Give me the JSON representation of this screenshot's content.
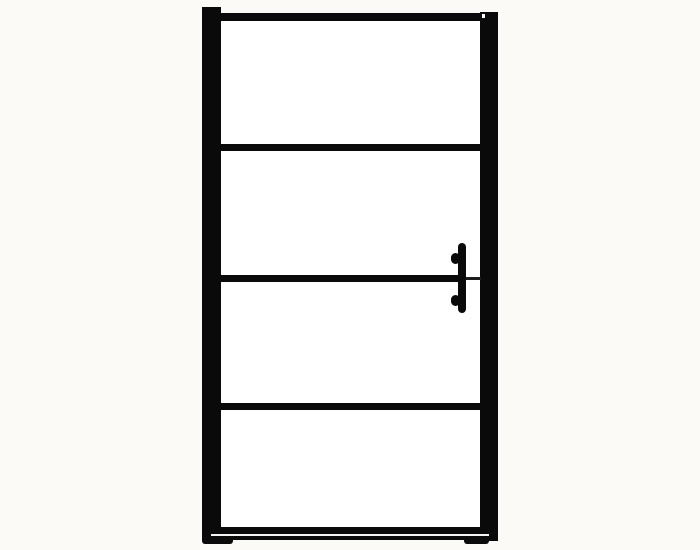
{
  "image": {
    "description": "Product photo of a black-framed glass door with three horizontal crossbars, a bottom rail with feet, and a vertical handle on the right side",
    "background_color": "#fbfaf7",
    "frame_color": "#0a0a0a",
    "glass_color": "#ffffff",
    "rail_highlight_color": "#f5f5f3",
    "thin_bar_color": "#1c1c1c",
    "panel_count": 4,
    "crossbar_count": 3,
    "handle": {
      "side": "right",
      "orientation": "vertical",
      "mounts": 2
    }
  }
}
